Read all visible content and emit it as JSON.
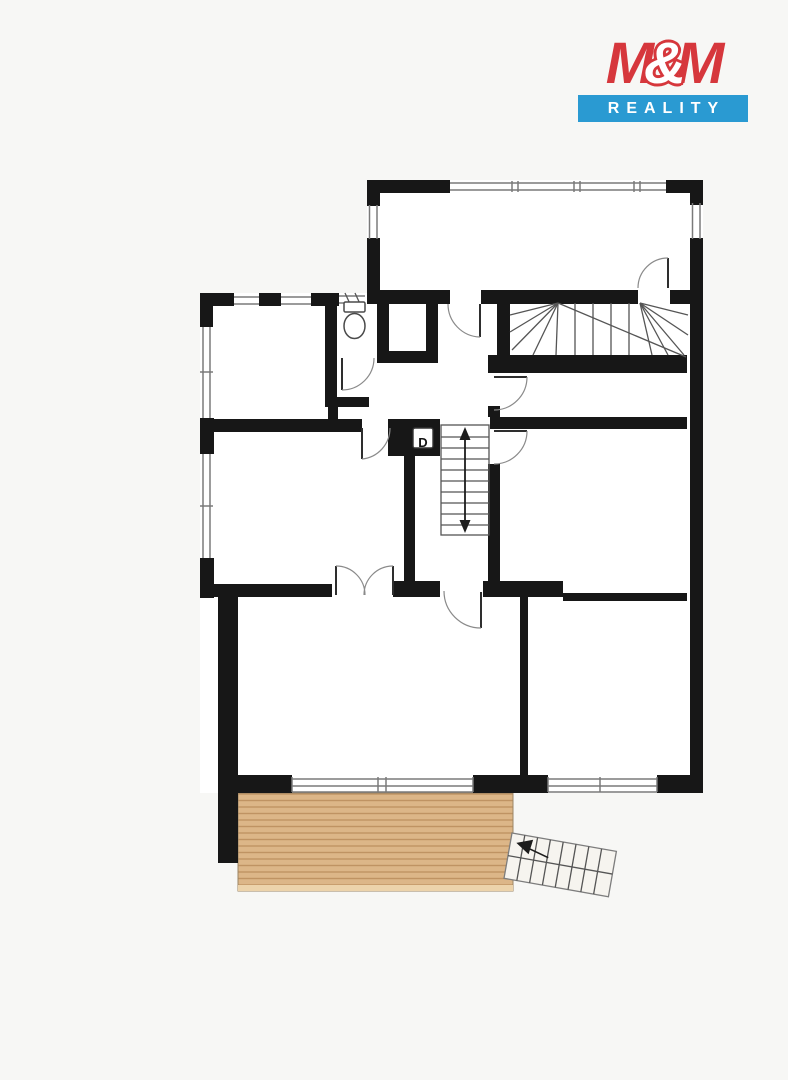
{
  "brand": {
    "m_left": "M",
    "ampersand": "&",
    "m_right": "M",
    "word_bottom": "REALITY",
    "color_red": "#d6373c",
    "color_blue": "#2a9ad2"
  },
  "floor_plan": {
    "duct_label": "D",
    "colors": {
      "wall": "#171717",
      "thin_line": "#555555",
      "window_line": "#7a7a7a",
      "deck_fill": "#dcb688",
      "deck_stripe": "#bf9363",
      "deck_edge": "#ecd3ab",
      "page_background": "#f7f7f5",
      "room_fill": "#ffffff"
    },
    "features": {
      "toilet": "toilet-icon",
      "winder_staircase": "winder-staircase",
      "main_staircase": "central-staircase-up-down-arrow",
      "exterior_staircase": "exterior-staircase-with-entry-arrow",
      "terrace": "wood-deck-terrace",
      "duct_shaft": "duct-shaft-box"
    }
  }
}
